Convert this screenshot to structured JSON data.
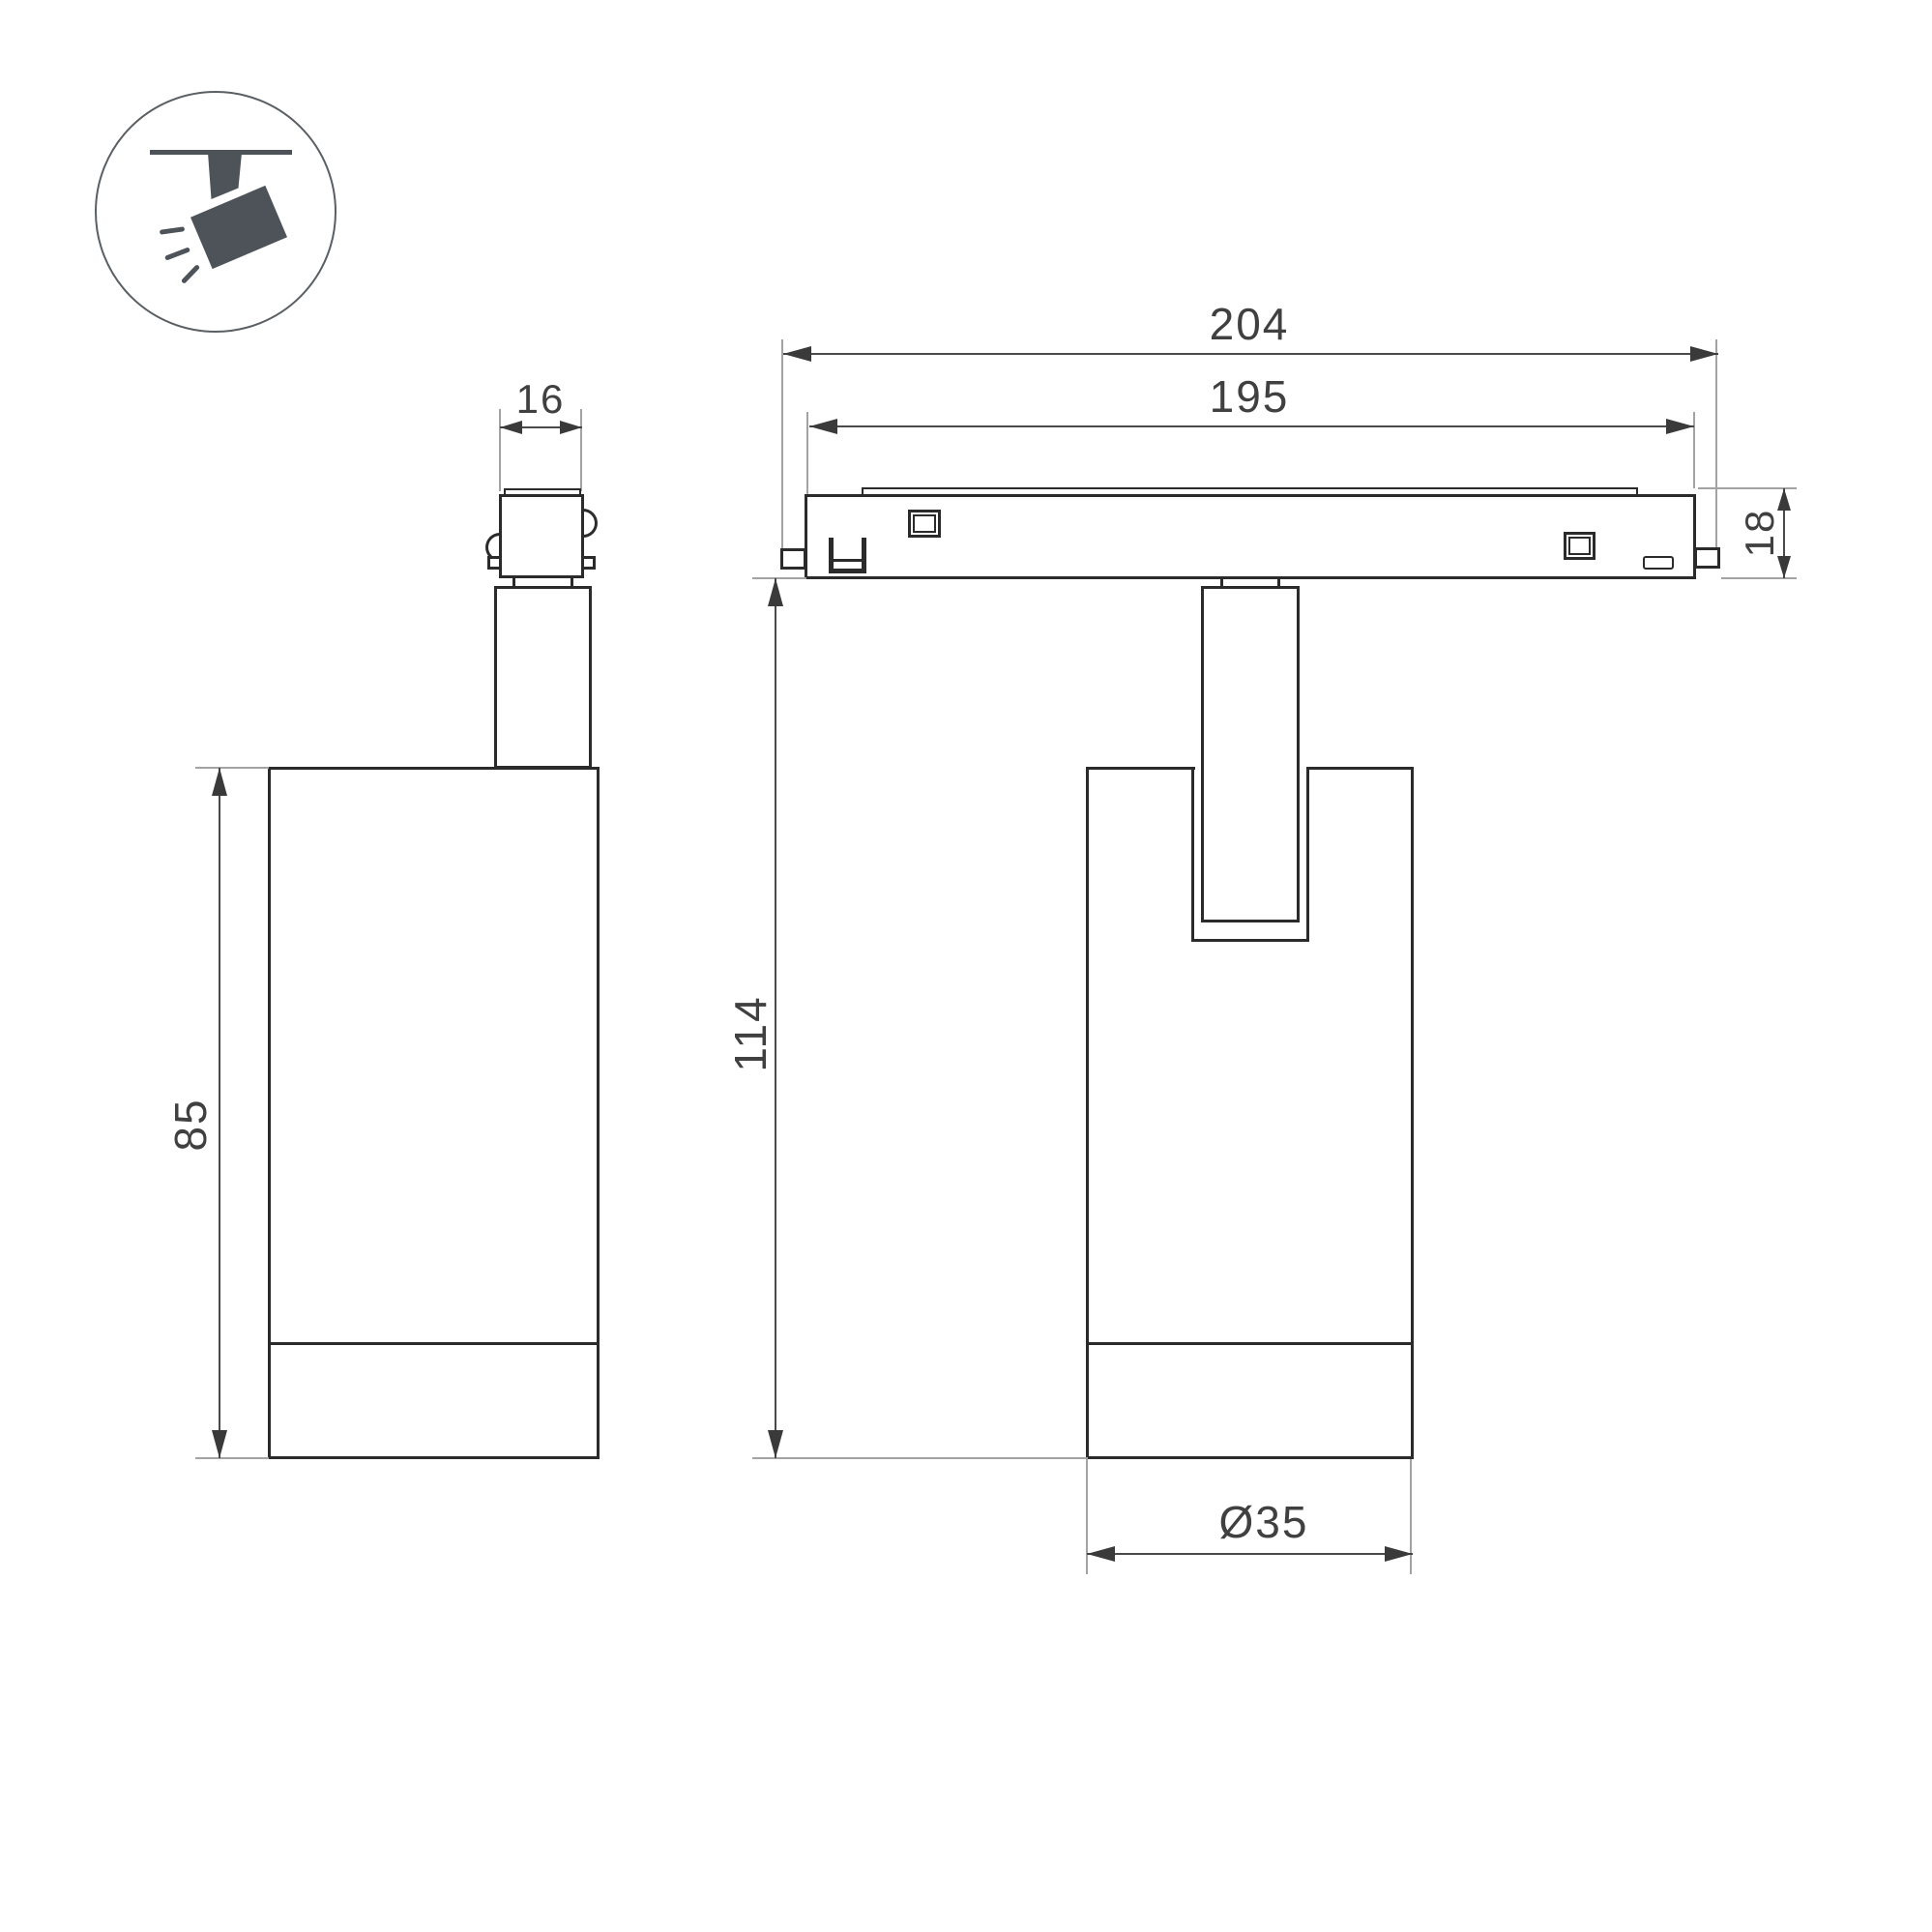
{
  "page": {
    "background": "#ffffff",
    "stroke_color": "#2b2b2b",
    "dimension_color": "#4a4a4a"
  },
  "icon": {
    "name": "ceiling-track-spotlight",
    "color": "#4e5359"
  },
  "dimensions": {
    "adapter_width": "16",
    "body_height": "85",
    "track_overall_length": "204",
    "track_body_length": "195",
    "track_height": "18",
    "overall_height": "114",
    "head_diameter": "Ø35"
  }
}
